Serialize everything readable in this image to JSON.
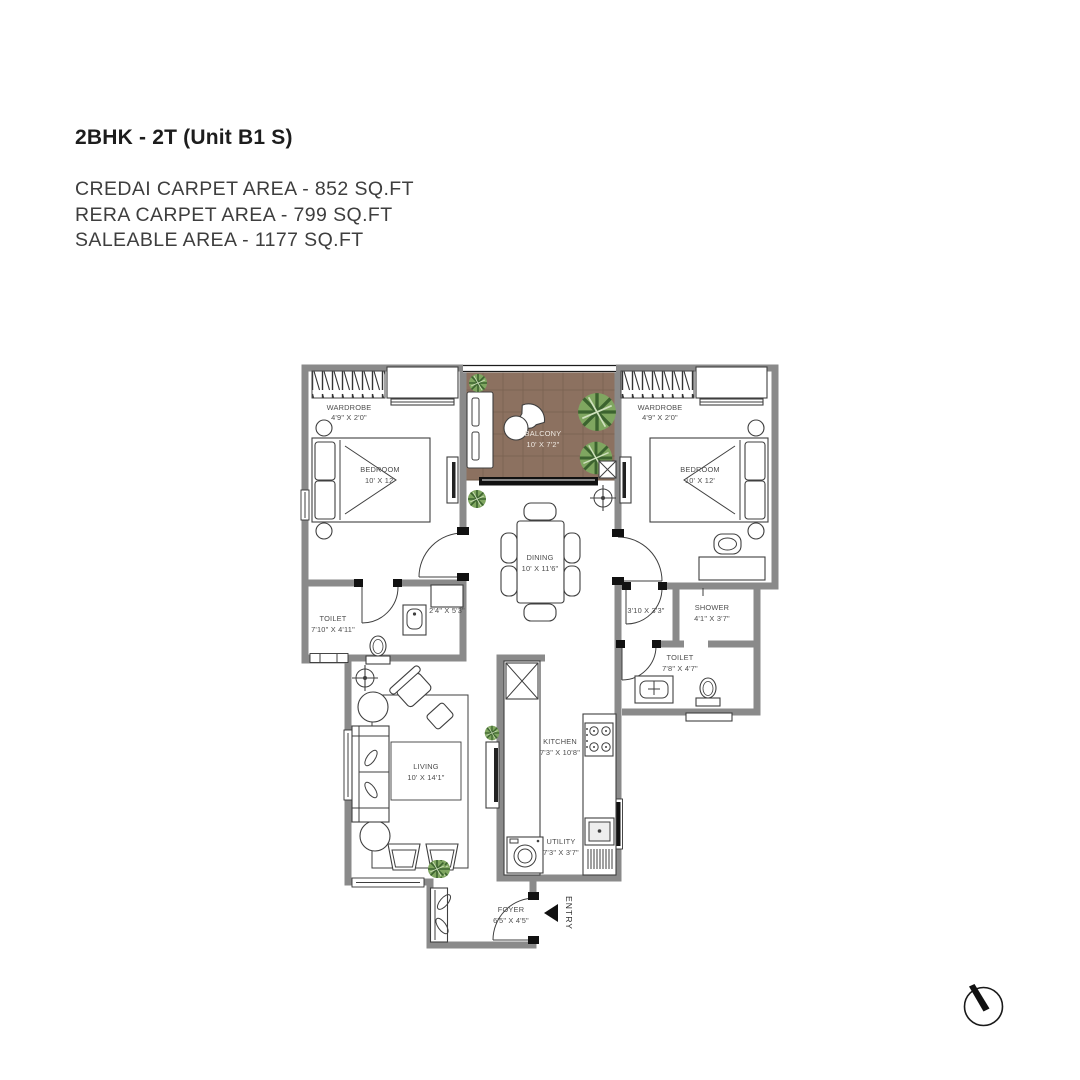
{
  "header": {
    "title": "2BHK - 2T (Unit B1 S)",
    "areas": [
      "CREDAI CARPET AREA - 852 SQ.FT",
      "RERA CARPET AREA - 799 SQ.FT",
      "SALEABLE AREA - 1177 SQ.FT"
    ]
  },
  "rooms": {
    "wardrobe1": {
      "name": "WARDROBE",
      "dims": "4'9\" X 2'0\""
    },
    "bedroom1": {
      "name": "BEDROOM",
      "dims": "10' X 12'"
    },
    "balcony": {
      "name": "BALCONY",
      "dims": "10' X 7'2\""
    },
    "wardrobe2": {
      "name": "WARDROBE",
      "dims": "4'9\" X 2'0\""
    },
    "bedroom2": {
      "name": "BEDROOM",
      "dims": "10' X 12'"
    },
    "dining": {
      "name": "DINING",
      "dims": "10' X 11'6\""
    },
    "toilet1": {
      "name": "TOILET",
      "dims": "7'10\" X 4'11\""
    },
    "passage1": {
      "dims": "2'4\" X 5'3\""
    },
    "passage2": {
      "dims": "3'10 X 3'3\""
    },
    "shower": {
      "name": "SHOWER",
      "dims": "4'1\" X 3'7\""
    },
    "toilet2": {
      "name": "TOILET",
      "dims": "7'8\" X 4'7\""
    },
    "living": {
      "name": "LIVING",
      "dims": "10' X 14'1\""
    },
    "kitchen": {
      "name": "KITCHEN",
      "dims": "7'3\" X 10'8\""
    },
    "utility": {
      "name": "UTILITY",
      "dims": "7'3\" X 3'7\""
    },
    "foyer": {
      "name": "FOYER",
      "dims": "6'5\" X 4'5\""
    }
  },
  "entry": {
    "label": "ENTRY"
  },
  "colors": {
    "wall": "#8a8a8a",
    "wood_floor": "#8c7160",
    "plant": "#7fa660",
    "text": "#4d4d4d"
  }
}
